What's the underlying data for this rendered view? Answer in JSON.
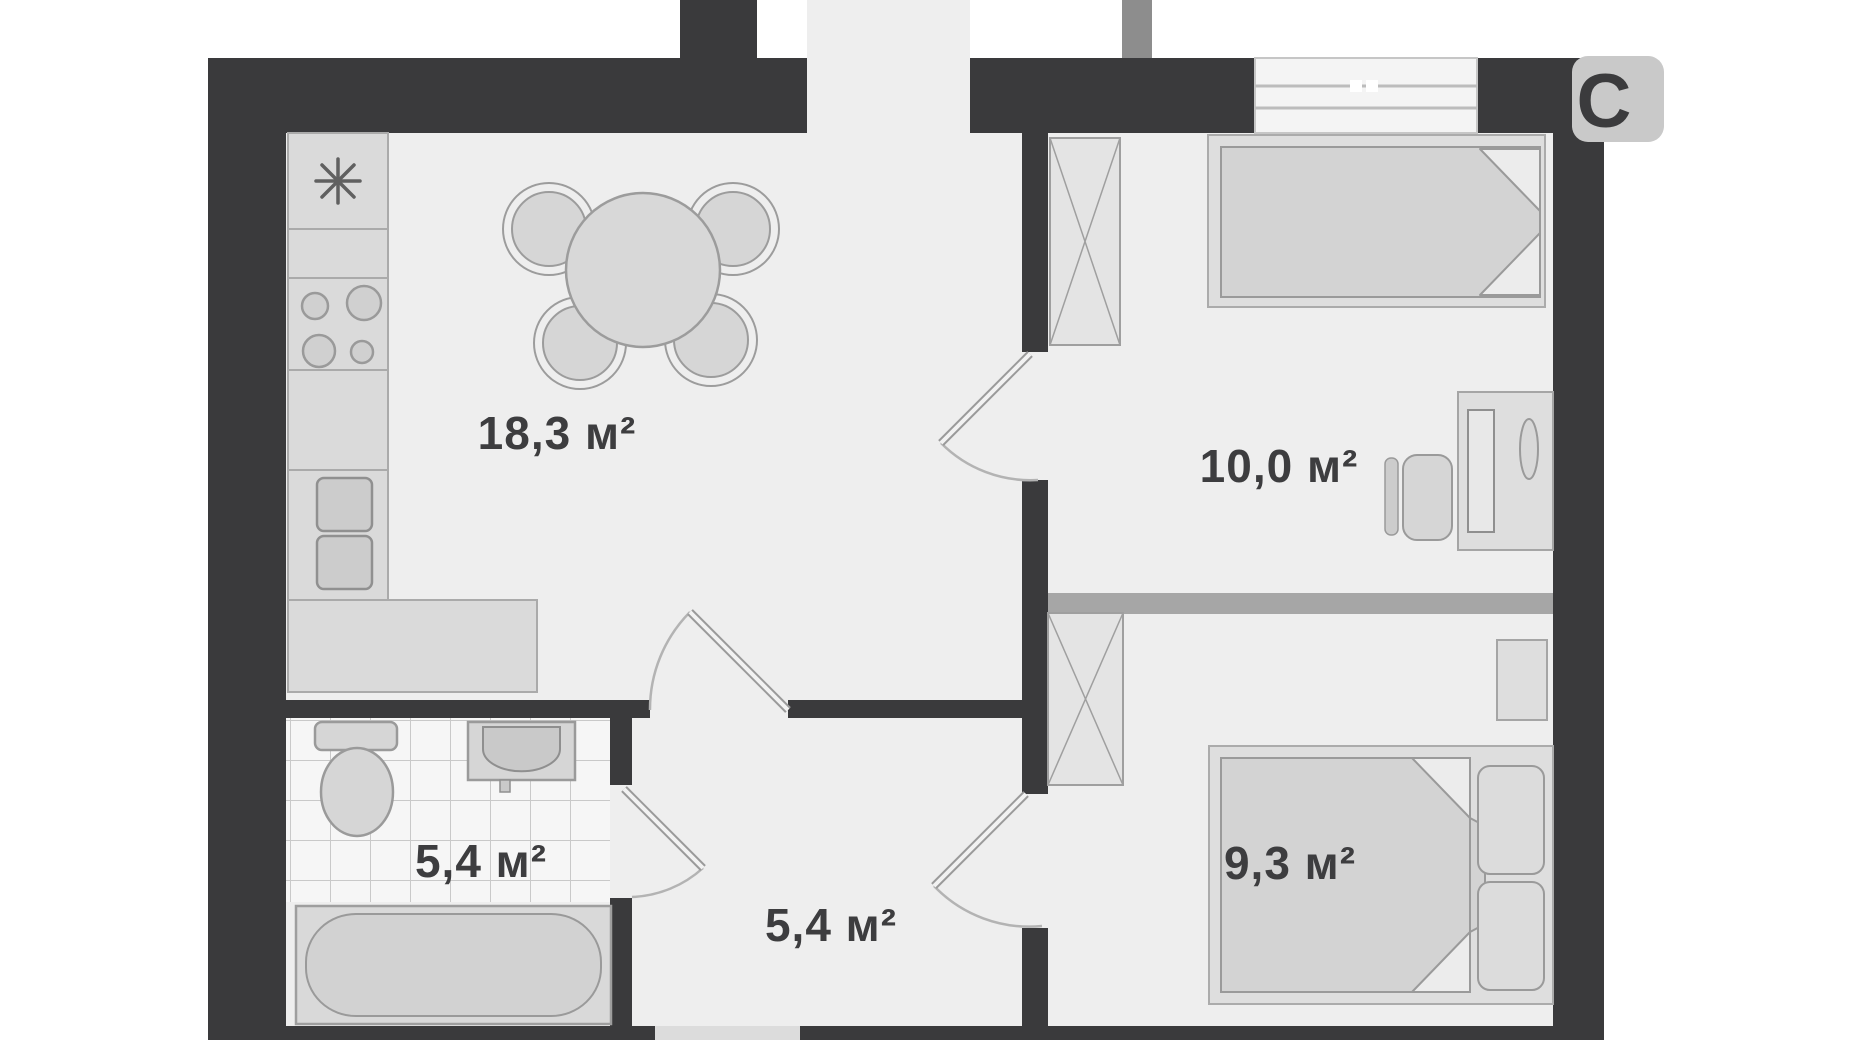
{
  "document": {
    "type": "apartment floor plan",
    "background": "#ffffff"
  },
  "rooms": [
    {
      "id": "kitchen-living-room",
      "area_label": "18,3 м²",
      "area_m2": 18.3
    },
    {
      "id": "bedroom-top-right",
      "area_label": "10,0 м²",
      "area_m2": 10.0
    },
    {
      "id": "bedroom-bottom-right",
      "area_label": "9,3 м²",
      "area_m2": 9.3
    },
    {
      "id": "bathroom",
      "area_label": "5,4 м²",
      "area_m2": 5.4
    },
    {
      "id": "hallway",
      "area_label": "5,4 м²",
      "area_m2": 5.4
    }
  ],
  "watermark": {
    "text": "C"
  },
  "colors": {
    "wall": "#3a3a3c",
    "floor": "#eeeeee",
    "furniture_fill": "#d4d4d4",
    "furniture_stroke": "#9c9c9c",
    "partition": "#a6a6a6",
    "tile_line": "#c9c9c9",
    "shaft_fill": "#e4e4e4",
    "door_arc": "#b3b3b3",
    "watermark_tile": "#c9c9c9",
    "label_text": "#3d3d3f"
  },
  "icons": {
    "fridge_snowflake_icon": "eight-point-asterisk",
    "stove_burners_icon": "four-circles",
    "ventilation_shaft_icon": "crossed-box"
  }
}
